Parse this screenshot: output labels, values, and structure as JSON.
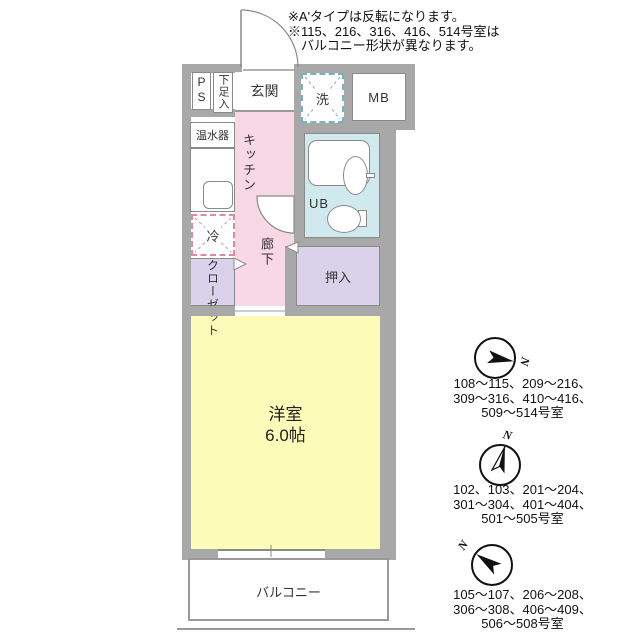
{
  "notes": {
    "lines": [
      "※A'タイプは反転になります。",
      "※115、216、316、416、514号室は",
      "バルコニー形状が異なります。"
    ]
  },
  "floorplan": {
    "labels": {
      "ps": "PS",
      "shoe_cabinet": "下足入",
      "entrance": "玄関",
      "washer": "洗",
      "meter_box": "MB",
      "water_heater": "温水器",
      "kitchen": "キッチン",
      "refrigerator": "冷",
      "corridor": "廊下",
      "unit_bath": "UB",
      "oshiire": "押入",
      "closet": "クローゼット",
      "western_room": "洋室",
      "western_room_size": "6.0帖",
      "balcony": "バルコニー"
    },
    "colors": {
      "wall": "#a8a8a8",
      "kitchen_corridor": "#f8d8e4",
      "western_room": "#fdfbb8",
      "unit_bath": "#cfe9ee",
      "storage": "#dad2ea",
      "washer_dash": "#74b3c4",
      "fridge_dash": "#e289a0"
    }
  },
  "orientation_sections": [
    {
      "north": "N",
      "lines": [
        "108〜115、209〜216、",
        "309〜316、410〜416、",
        "509〜514号室"
      ]
    },
    {
      "north": "N",
      "lines": [
        "102、103、201〜204、",
        "301〜304、401〜404、",
        "501〜505号室"
      ]
    },
    {
      "north": "N",
      "lines": [
        "105〜107、206〜208、",
        "306〜308、406〜409、",
        "506〜508号室"
      ]
    }
  ]
}
